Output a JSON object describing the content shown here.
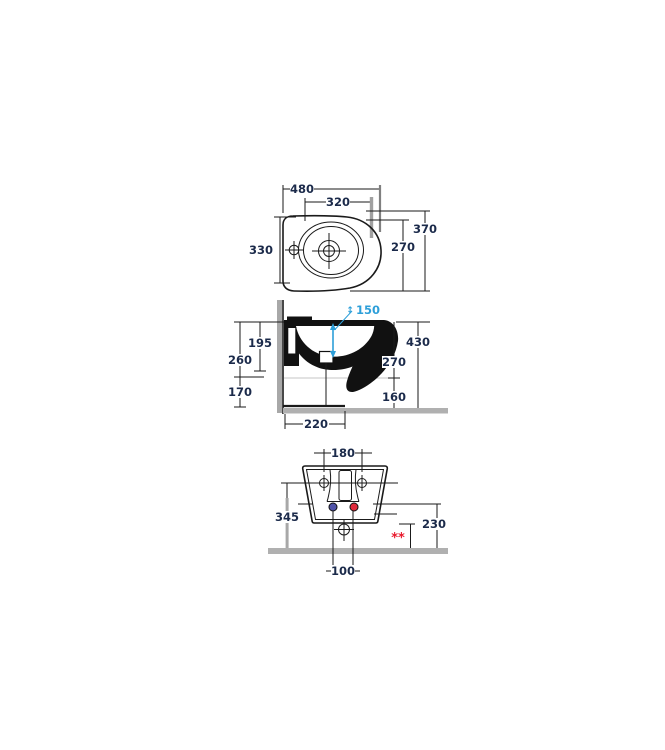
{
  "drawing": {
    "type": "technical-drawing",
    "subject": "wall-hung bidet, three orthographic views with installation dimensions",
    "units": "mm",
    "colors": {
      "line": "#1a1a1a",
      "dim_text": "#1b2a4a",
      "accent_blue": "#2d9fd9",
      "wall_gray": "#a8a8a8",
      "floor_gray": "#b0b0b0",
      "red": "#e8192c",
      "cold_dot_blue": "#5053a8",
      "hot_dot_red": "#e02a3c"
    },
    "icons": {
      "updown": "↕"
    },
    "views": {
      "top": {
        "w480": "480",
        "w320": "320",
        "h330": "330",
        "h370": "370",
        "h270": "270"
      },
      "side": {
        "jet150": "150",
        "d195": "195",
        "d260": "260",
        "d170": "170",
        "d430": "430",
        "d270": "270",
        "d160": "160",
        "d220": "220"
      },
      "front": {
        "w180": "180",
        "h345": "345",
        "h230": "230",
        "w100": "100",
        "footnote": "**"
      }
    }
  }
}
